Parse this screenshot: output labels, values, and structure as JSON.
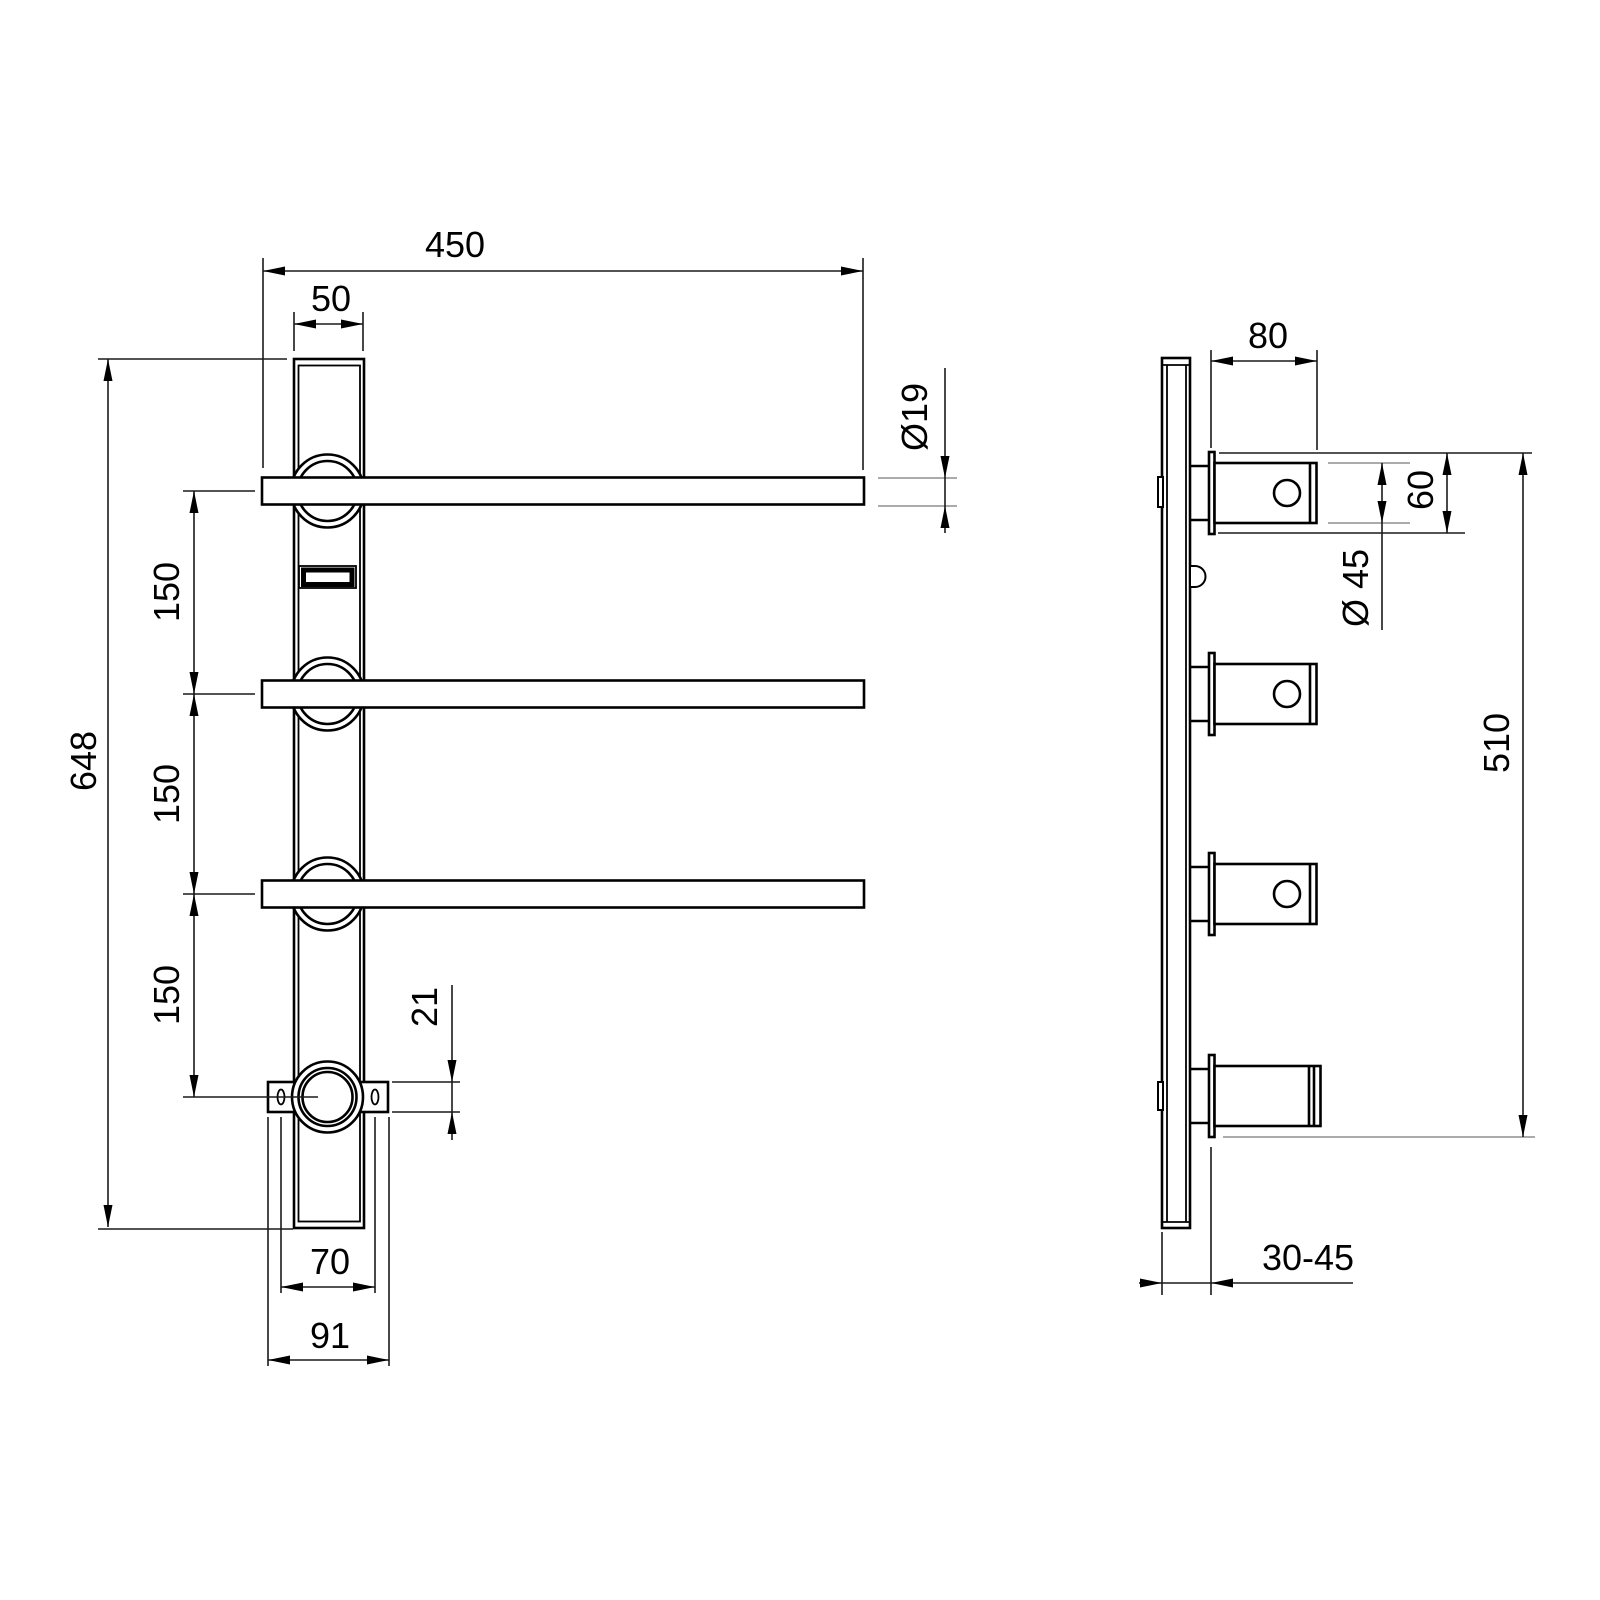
{
  "dimensions": {
    "front_view": {
      "rail_length": "450",
      "bar_width": "50",
      "rail_diameter": "Ø19",
      "total_height": "648",
      "rail_spacing_top": "150",
      "rail_spacing_middle": "150",
      "rail_spacing_bottom": "150",
      "flange_thickness": "21",
      "flange_hole_spacing": "70",
      "flange_width": "91"
    },
    "side_view": {
      "arm_projection": "80",
      "escutcheon_height": "60",
      "body_diameter": "Ø 45",
      "mounting_height": "510",
      "wall_depth_range": "30-45"
    }
  }
}
